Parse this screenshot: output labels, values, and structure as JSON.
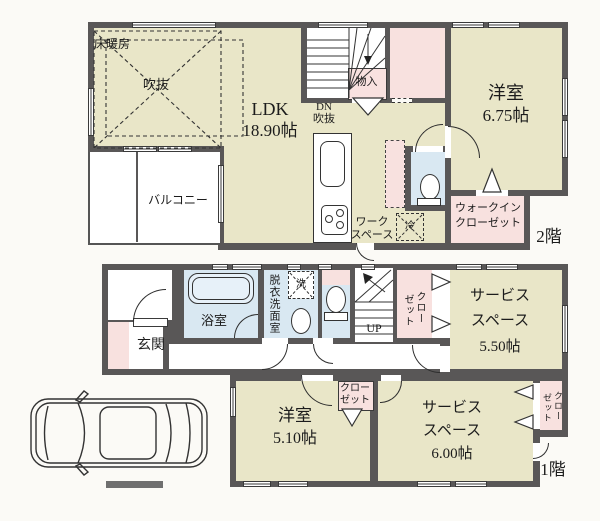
{
  "colors": {
    "wall": "#595757",
    "room_beige": "#e9e6c8",
    "room_pink": "#f8e1df",
    "room_blue": "#d9e8f2",
    "text": "#1c1c1c"
  },
  "floor2": {
    "badge": "2階",
    "ldk": {
      "name": "LDK",
      "area": "18.90帖"
    },
    "floor_heating": "床暖房",
    "atrium": "吹抜",
    "dn": "DN",
    "dn_atrium": "吹抜",
    "storage": "物入",
    "balcony": "バルコニー",
    "workspace": [
      "ワーク",
      "スペース"
    ],
    "fridge": "冷",
    "bedroom": {
      "name": "洋室",
      "area": "6.75帖"
    },
    "wic": [
      "ウォークイン",
      "クローゼット"
    ]
  },
  "floor1": {
    "badge": "1階",
    "entrance": "玄関",
    "bathroom": "浴室",
    "washroom": "脱衣洗面室",
    "laundry": "洗",
    "stairs_up": "UP",
    "closet_hall": [
      "クロー",
      "ゼット"
    ],
    "service_a": {
      "name1": "サービス",
      "name2": "スペース",
      "area": "5.50帖"
    },
    "closet_bedroom": [
      "クロー",
      "ゼット"
    ],
    "bedroom": {
      "name": "洋室",
      "area": "5.10帖"
    },
    "service_b": {
      "name1": "サービス",
      "name2": "スペース",
      "area": "6.00帖"
    },
    "closet_service": [
      "クロー",
      "ゼット"
    ]
  }
}
